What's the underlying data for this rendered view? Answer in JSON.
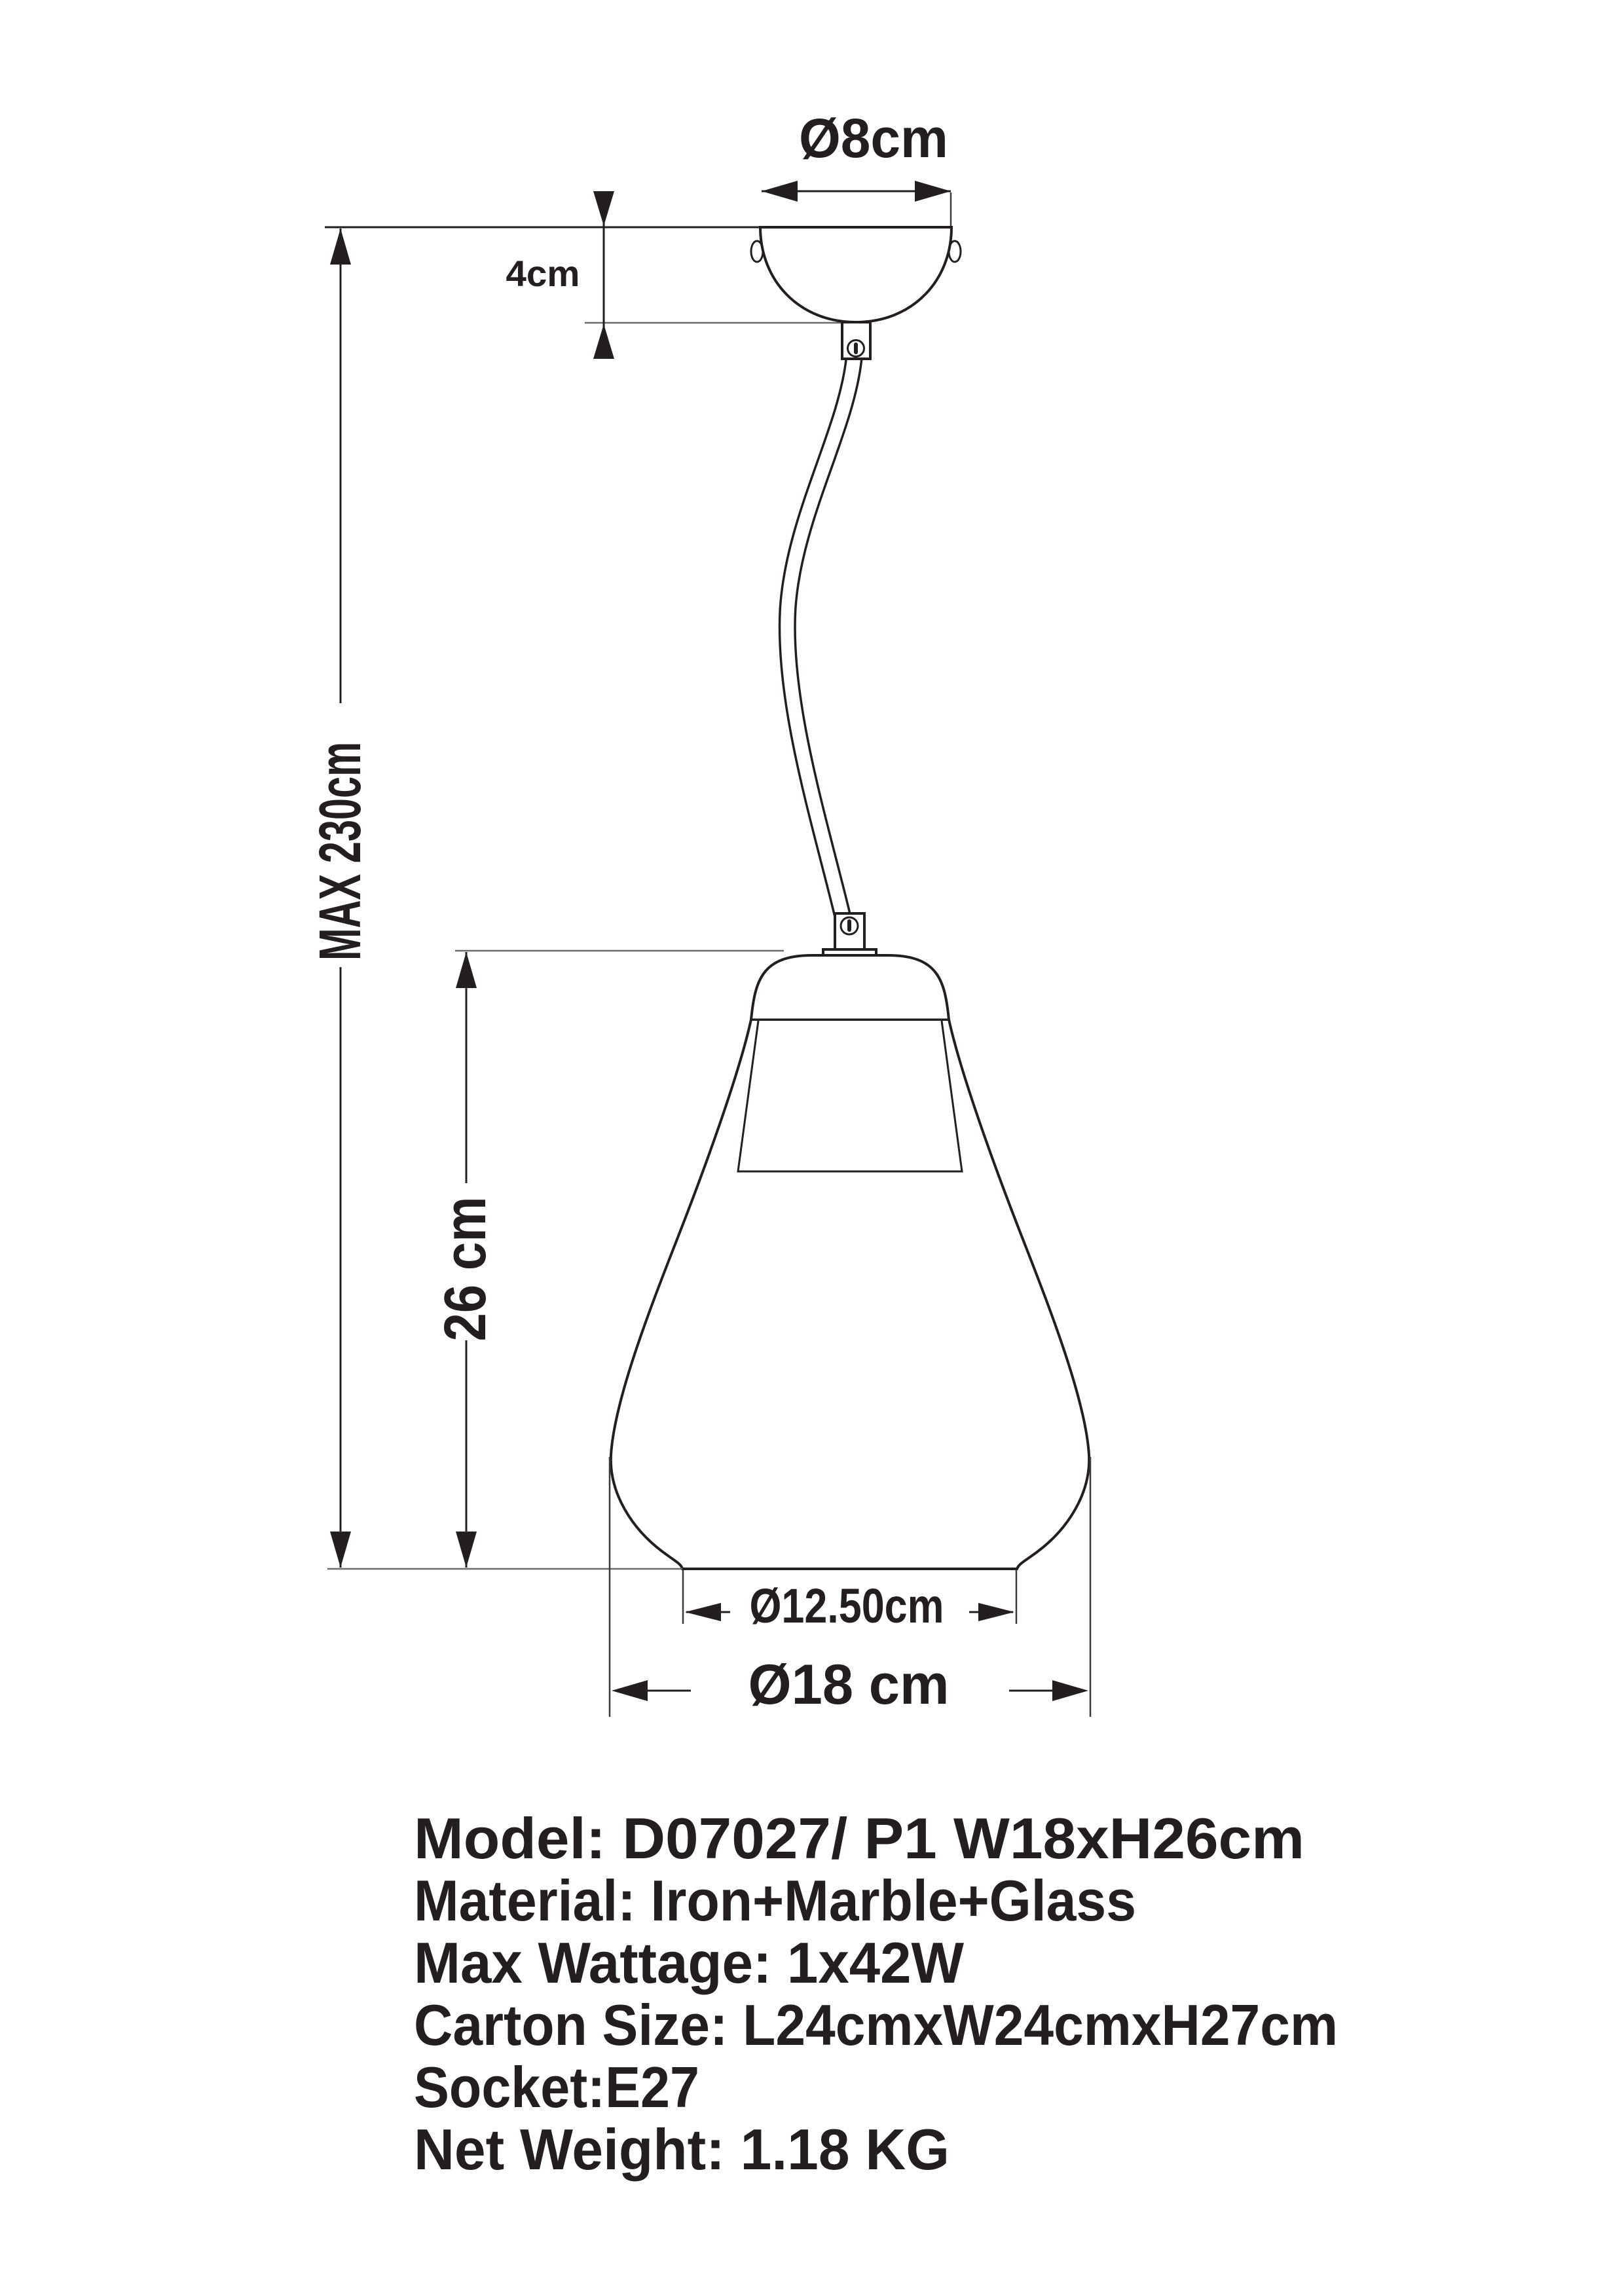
{
  "title": "Pendant lamp technical dimension drawing",
  "dimensions": {
    "canopy_diameter": "Ø8cm",
    "canopy_height": "4cm",
    "max_height": "MAX 230cm",
    "shade_height": "26 cm",
    "bottom_inner_diameter": "Ø12.50cm",
    "shade_diameter": "Ø18 cm"
  },
  "specs": {
    "lines": [
      "Model: D07027/ P1 W18xH26cm",
      "Material: Iron+Marble+Glass",
      "Max Wattage: 1x42W",
      "Carton Size: L24cmxW24cmxH27cm",
      "Socket:E27",
      "Net Weight: 1.18 KG"
    ]
  },
  "colors": {
    "line": "#231f20",
    "background": "#ffffff"
  }
}
